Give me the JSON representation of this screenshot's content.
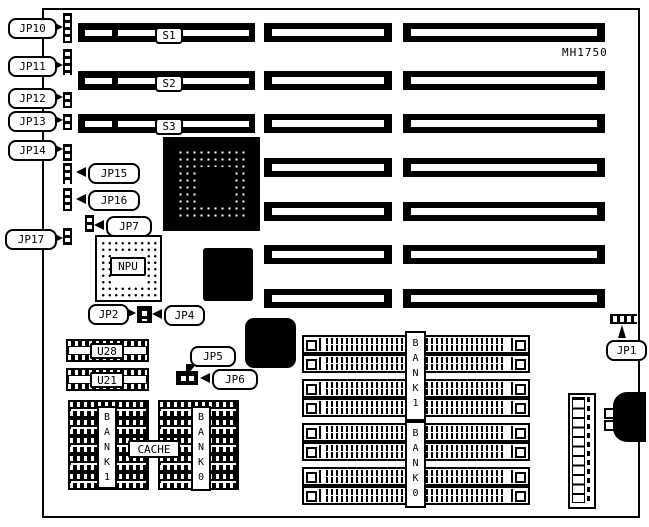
{
  "board": {
    "model": "MH1750"
  },
  "slots": {
    "s1": "S1",
    "s2": "S2",
    "s3": "S3"
  },
  "jumpers": {
    "jp1": "JP1",
    "jp2": "JP2",
    "jp4": "JP4",
    "jp5": "JP5",
    "jp6": "JP6",
    "jp7": "JP7",
    "jp10": "JP10",
    "jp11": "JP11",
    "jp12": "JP12",
    "jp13": "JP13",
    "jp14": "JP14",
    "jp15": "JP15",
    "jp16": "JP16",
    "jp17": "JP17"
  },
  "chips": {
    "npu": "NPU",
    "u28": "U28",
    "u21": "U21",
    "cache": "CACHE",
    "dip_bank1": "B\nA\nN\nK\n1",
    "dip_bank0": "B\nA\nN\nK\n0",
    "simm_bank1": "B\nA\nN\nK\n1",
    "simm_bank0": "B\nA\nN\nK\n0"
  },
  "colors": {
    "ink": "#000000",
    "paper": "#ffffff"
  }
}
